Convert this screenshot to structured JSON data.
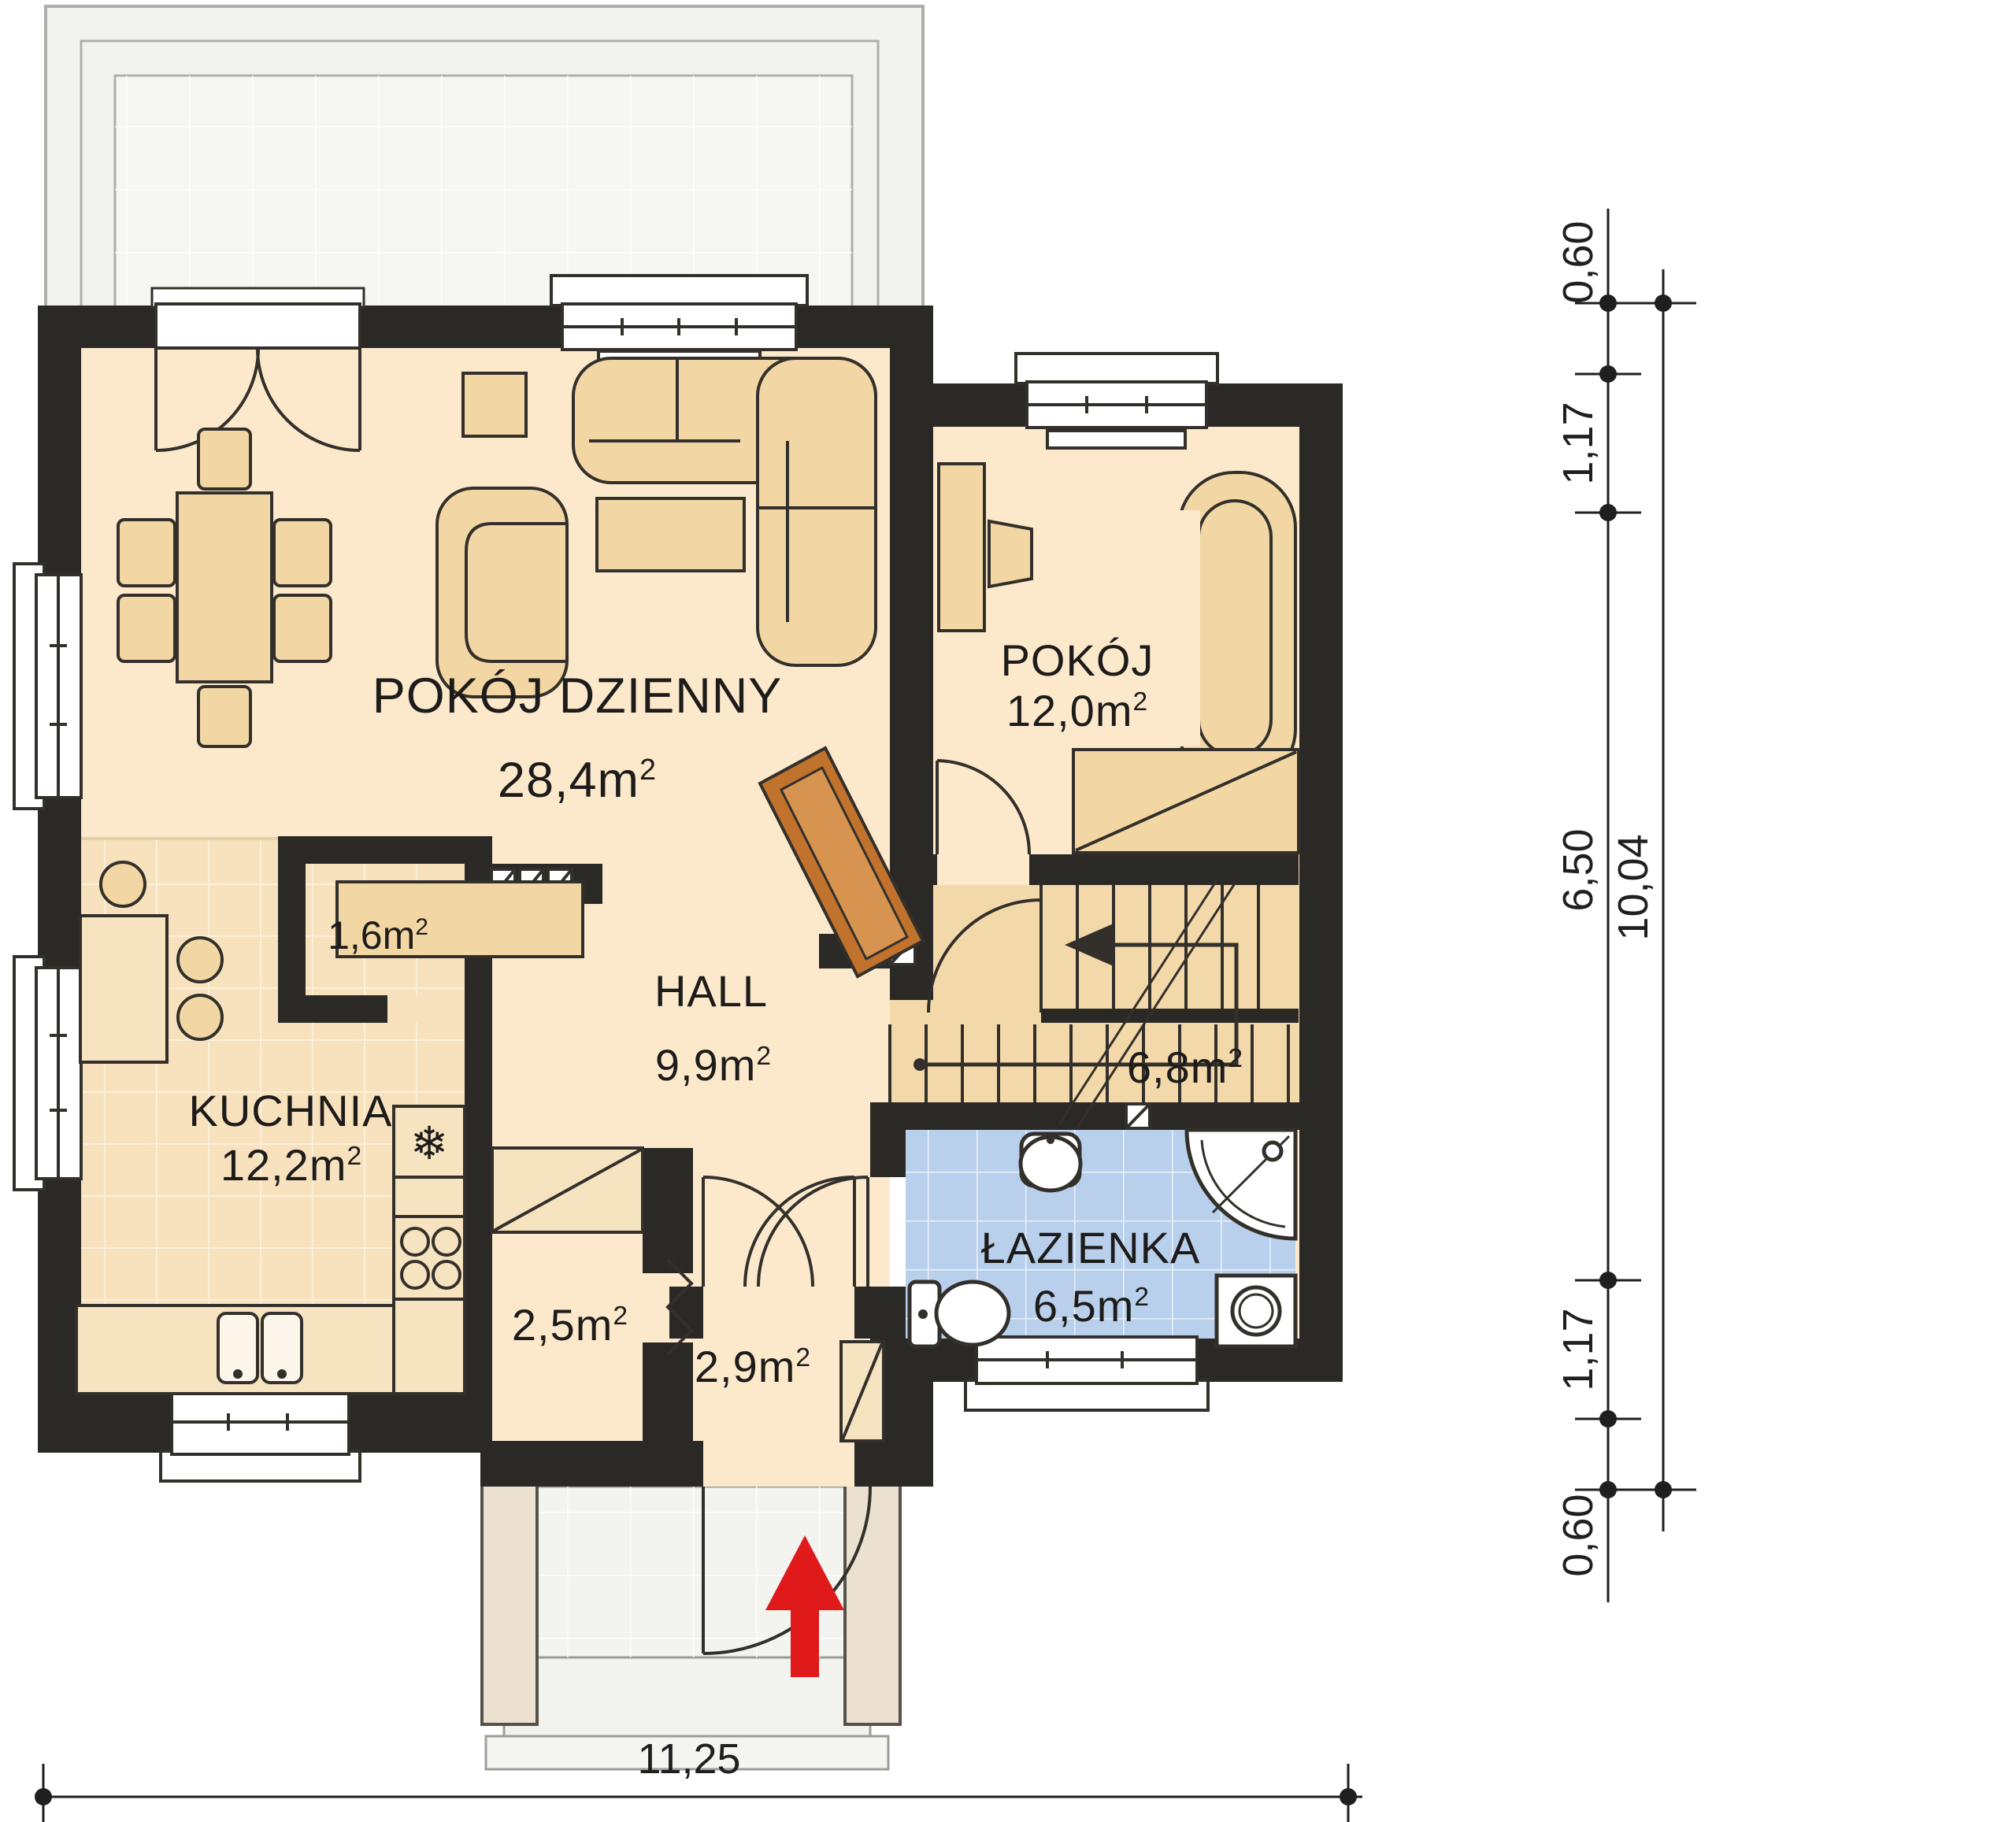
{
  "rooms": {
    "living": {
      "name": "POKÓJ DZIENNY",
      "area": "28,4"
    },
    "bedroom": {
      "name": "POKÓJ",
      "area": "12,0"
    },
    "hall": {
      "name": "HALL",
      "area": "9,9"
    },
    "kitchen": {
      "name": "KUCHNIA",
      "area": "12,2"
    },
    "bathroom": {
      "name": "ŁAZIENKA",
      "area": "6,5"
    },
    "pantry": {
      "area": "1,6"
    },
    "stairs": {
      "area": "6,8"
    },
    "closet": {
      "area": "2,5"
    },
    "vestibule": {
      "area": "2,9"
    }
  },
  "units": {
    "area_suffix": "m",
    "sup": "2"
  },
  "dimensions": {
    "vertical_segments": [
      "0,60",
      "1,17",
      "6,50",
      "1,17",
      "0,60"
    ],
    "vertical_total": "10,04",
    "horizontal_total": "11,25"
  },
  "icons": {
    "fridge_snowflake": "❄"
  },
  "colors": {
    "wall": "#2b2926",
    "floor": "#fce9cc",
    "kitchen_tile": "#f8e2bd",
    "bathroom_tile": "#b9d0ec",
    "furniture": "#f2d7a4",
    "terrace": "#f2f2ef",
    "fireplace": "#c1722d",
    "entrance_arrow": "#e01a1a"
  }
}
